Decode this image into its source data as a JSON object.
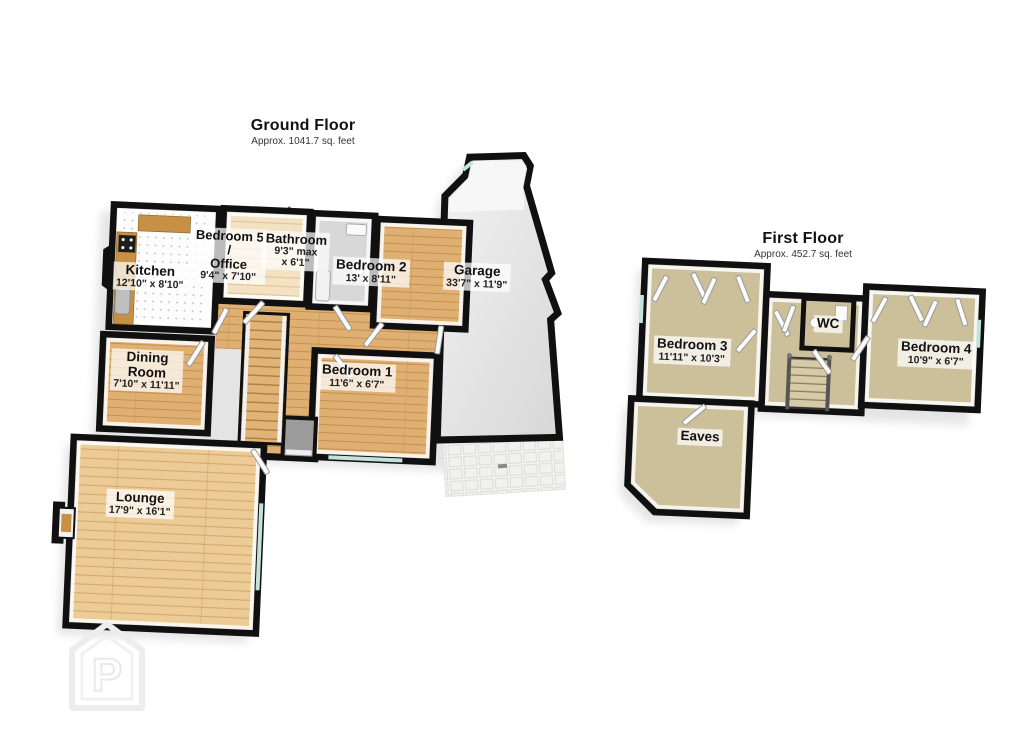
{
  "ground_floor": {
    "title": "Ground Floor",
    "subtitle": "Approx. 1041.7 sq. feet",
    "rooms": {
      "kitchen": {
        "name": "Kitchen",
        "dims": "12'10\" x 8'10\""
      },
      "bedroom5_office": {
        "name_line1": "Bedroom 5",
        "name_line2": "/",
        "name_line3": "Office",
        "dims": "9'4\" x 7'10\""
      },
      "bathroom": {
        "name": "Bathroom",
        "dims_line1": "9'3\" max",
        "dims_line2": "x 6'1\""
      },
      "bedroom2": {
        "name": "Bedroom 2",
        "dims": "13' x 8'11\""
      },
      "garage": {
        "name": "Garage",
        "dims": "33'7\" x 11'9\""
      },
      "dining_room": {
        "name_line1": "Dining",
        "name_line2": "Room",
        "dims": "7'10\" x 11'11\""
      },
      "bedroom1": {
        "name": "Bedroom 1",
        "dims": "11'6\" x 6'7\""
      },
      "lounge": {
        "name": "Lounge",
        "dims": "17'9\" x 16'1\""
      }
    }
  },
  "first_floor": {
    "title": "First Floor",
    "subtitle": "Approx. 452.7 sq. feet",
    "rooms": {
      "bedroom3": {
        "name": "Bedroom 3",
        "dims": "11'11\" x 10'3\""
      },
      "wc": {
        "name": "WC"
      },
      "bedroom4": {
        "name": "Bedroom 4",
        "dims": "10'9\" x 6'7\""
      },
      "eaves": {
        "name": "Eaves"
      }
    }
  },
  "watermark": {
    "letter": "P"
  },
  "colors": {
    "wall": "#101010",
    "wood_floor": "#e3b478",
    "lounge_wood": "#eccb96",
    "carpet": "#ccc09a",
    "garage_floor": "#e6e6e6",
    "window_glass": "#c2e2da",
    "counter_wood": "#c79045",
    "label_background": "rgba(255,255,255,0.72)"
  }
}
